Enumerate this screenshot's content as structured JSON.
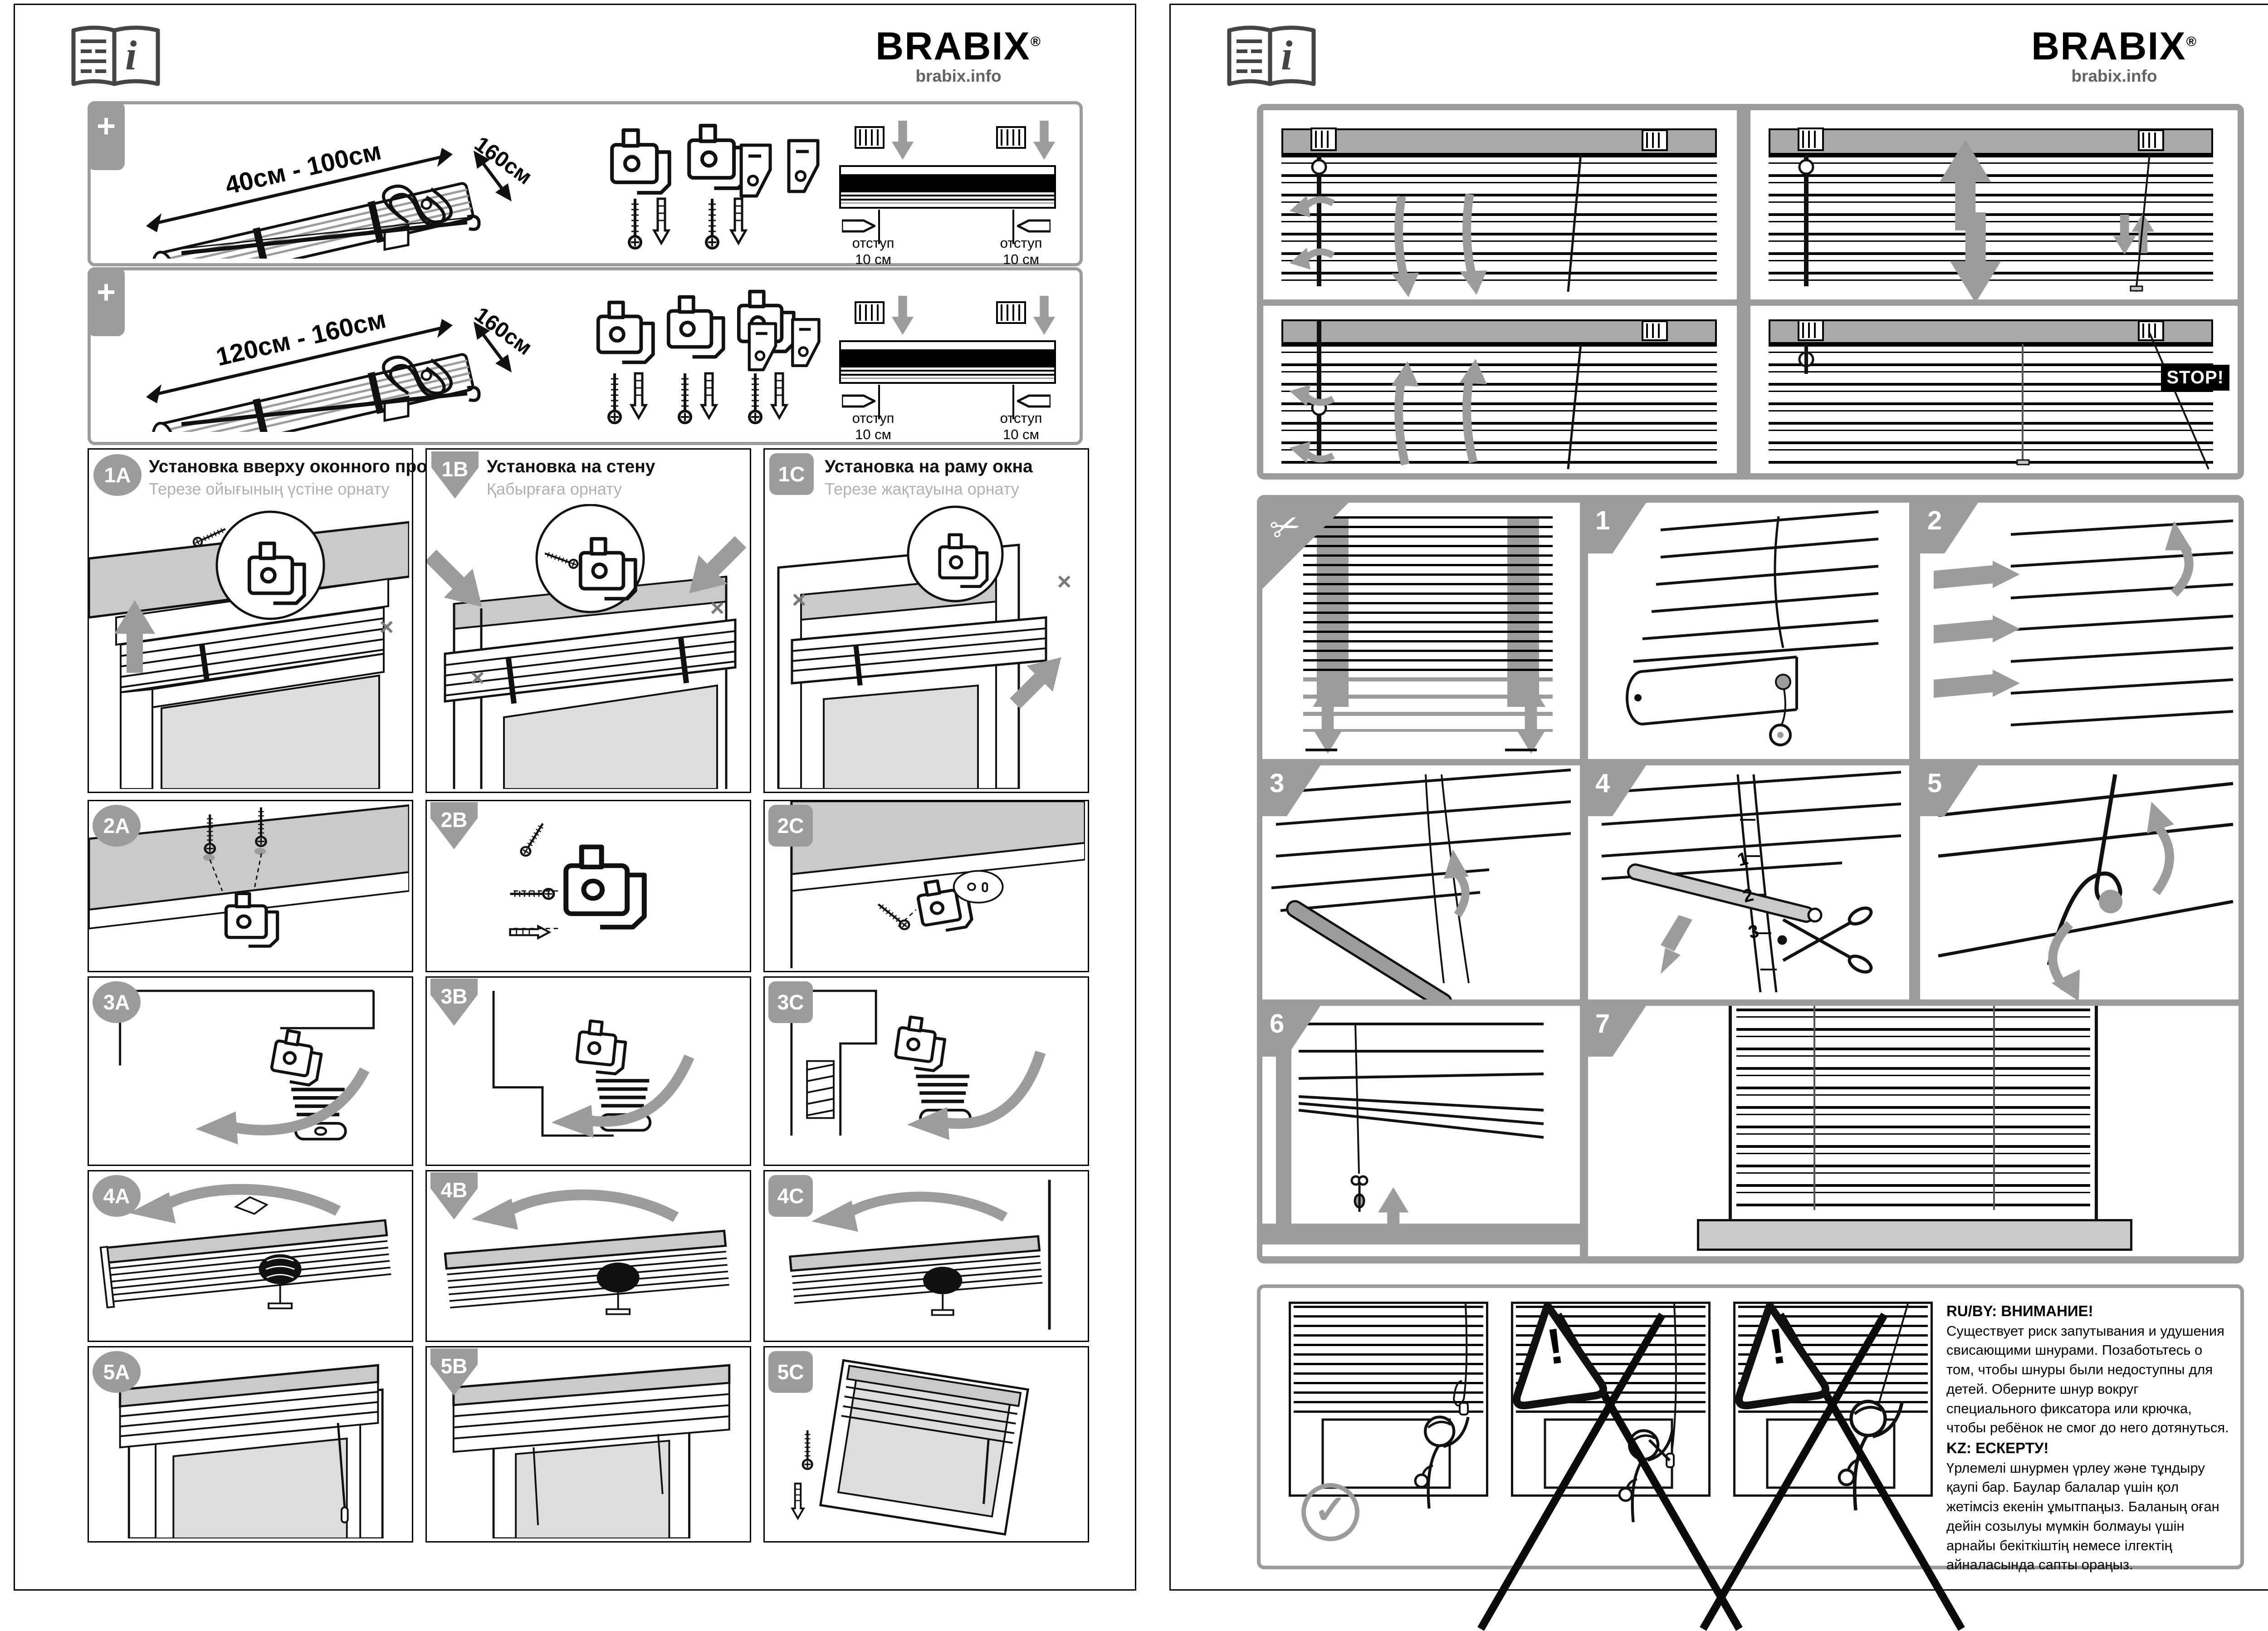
{
  "brand": {
    "name": "BRABIX",
    "reg": "®",
    "site": "brabix.info"
  },
  "colors": {
    "accent_grey": "#9c9c9c",
    "surface_grey": "#c9c9c9",
    "headbar_grey": "#a9a9a9",
    "line_black": "#111111",
    "subtitle_grey": "#b1b1b1"
  },
  "icons": {
    "info": "i",
    "plus": "+",
    "scissors": "✂",
    "check": "✓",
    "cross": "×",
    "warn": "!"
  },
  "left_page": {
    "kit_rows": [
      {
        "width_range": "40см - 100см",
        "depth": "160см",
        "offset_line1": "отступ",
        "offset_line2": "10 см"
      },
      {
        "width_range": "120см - 160см",
        "depth": "160см",
        "offset_line1": "отступ",
        "offset_line2": "10 см"
      }
    ],
    "columns": [
      {
        "badge": "1A",
        "title": "Установка вверху оконного проема",
        "subtitle": "Терезе ойығының үстіне орнату",
        "steps": [
          "2A",
          "3A",
          "4A",
          "5A"
        ]
      },
      {
        "badge": "1B",
        "title": "Установка на стену",
        "subtitle": "Қабырғаға орнату",
        "steps": [
          "2B",
          "3B",
          "4B",
          "5B"
        ]
      },
      {
        "badge": "1C",
        "title": "Установка на раму окна",
        "subtitle": "Терезе жақтауына орнату",
        "steps": [
          "2C",
          "3C",
          "4C",
          "5C"
        ]
      }
    ]
  },
  "right_page": {
    "stop_label": "STOP!",
    "steps": [
      "1",
      "2",
      "3",
      "4",
      "5",
      "6",
      "7"
    ],
    "ladder_numbers": [
      "1",
      "2",
      "3"
    ],
    "warning": {
      "ru_title": "RU/BY: ВНИМАНИЕ!",
      "ru_body": "Существует риск запутывания и удушения свисающими шнурами. Позаботьтесь о том, чтобы шнуры были недоступны для детей. Оберните шнур вокруг специального фиксатора или крючка, чтобы ребёнок не смог до него дотянуться.",
      "kz_title": "KZ: ЕСКЕРТУ!",
      "kz_body": "Үрлемелі шнурмен үрлеу және тұндыру қаупі бар. Баулар балалар үшін қол жетімсіз екенін ұмытпаңыз. Баланың оған дейін созылуы мүмкін болмауы үшін арнайы бекіткіштің немесе ілгектің айналасында сапты ораңыз."
    }
  }
}
